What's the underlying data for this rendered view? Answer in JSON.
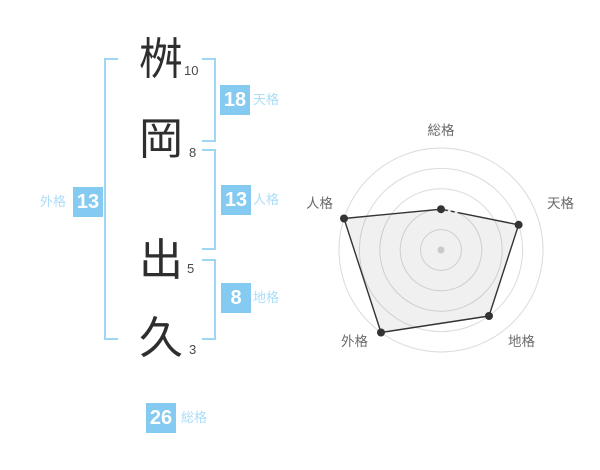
{
  "name_diagram": {
    "surname": [
      {
        "char": "桝",
        "strokes": "10"
      },
      {
        "char": "岡",
        "strokes": "8"
      }
    ],
    "given_name": [
      {
        "char": "出",
        "strokes": "5"
      },
      {
        "char": "久",
        "strokes": "3"
      }
    ],
    "badges": {
      "tenkaku": {
        "value": "18",
        "label": "天格"
      },
      "jinkaku": {
        "value": "13",
        "label": "人格"
      },
      "chikaku": {
        "value": "8",
        "label": "地格"
      },
      "gaikaku": {
        "value": "13",
        "label": "外格"
      },
      "soukaku": {
        "value": "26",
        "label": "総格"
      }
    }
  },
  "chart_data": {
    "type": "radar",
    "title": "",
    "categories": [
      "総格",
      "天格",
      "地格",
      "外格",
      "人格"
    ],
    "values": [
      2,
      4,
      4,
      5,
      5
    ],
    "scale_max": 5,
    "rings": 5,
    "axis_order": "clockwise-from-top",
    "grid": "concentric-circles",
    "partial_dashed_edges": [
      0
    ],
    "colors": {
      "line": "#333333",
      "fill": "rgba(0,0,0,0.06)",
      "grid": "#dbdbdb",
      "center_dot": "#c9c9c9",
      "label": "#6b6b6b"
    }
  },
  "colors": {
    "badge_bg": "#85caf0",
    "badge_text": "#ffffff",
    "badge_label": "#abddf8",
    "bracket": "#9fd6f4",
    "kanji": "#2e2e2e",
    "stroke_count": "#4a4a4a"
  }
}
